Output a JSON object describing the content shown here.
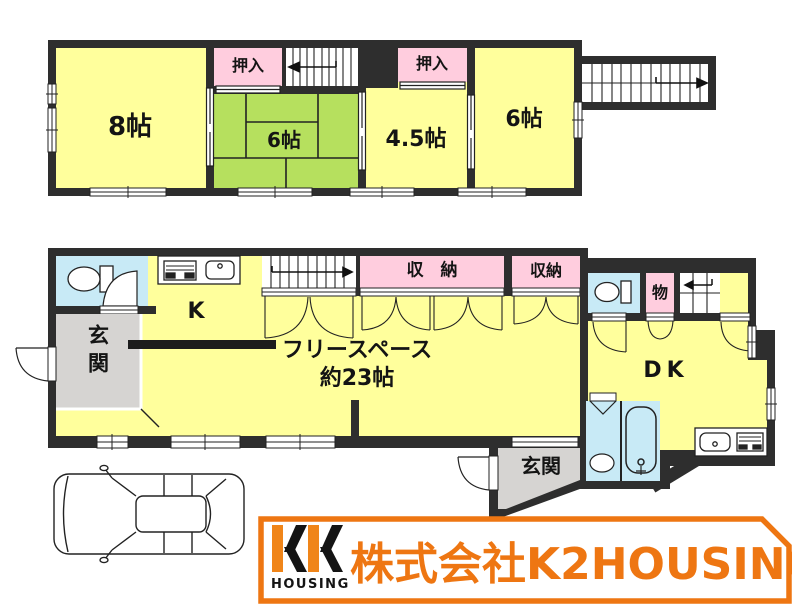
{
  "colors": {
    "wall": "#2e2e2e",
    "room_yellow": "#FFFF9C",
    "tatami_green": "#B6E05E",
    "closet_pink": "#FFCDDE",
    "water_blue": "#C8EAF6",
    "entry_gray": "#D6D4D2",
    "brand_orange": "#EE7612"
  },
  "floor2": {
    "room_8": "8帖",
    "closet_a": "押入",
    "room_6_tatami": "6帖",
    "closet_b": "押入",
    "room_4_5": "4.5帖",
    "room_6": "6帖"
  },
  "floor1": {
    "entry_left": "玄関",
    "kitchen": "K",
    "free_space_line1": "フリースペース",
    "free_space_line2": "約23帖",
    "storage_wide": "収　納",
    "storage": "収納",
    "small_closet": "物",
    "dining_kitchen": "DK",
    "entry_right": "玄関"
  },
  "branding": {
    "logo_sub": "HOUSING",
    "company_name": "株式会社K2HOUSING"
  }
}
